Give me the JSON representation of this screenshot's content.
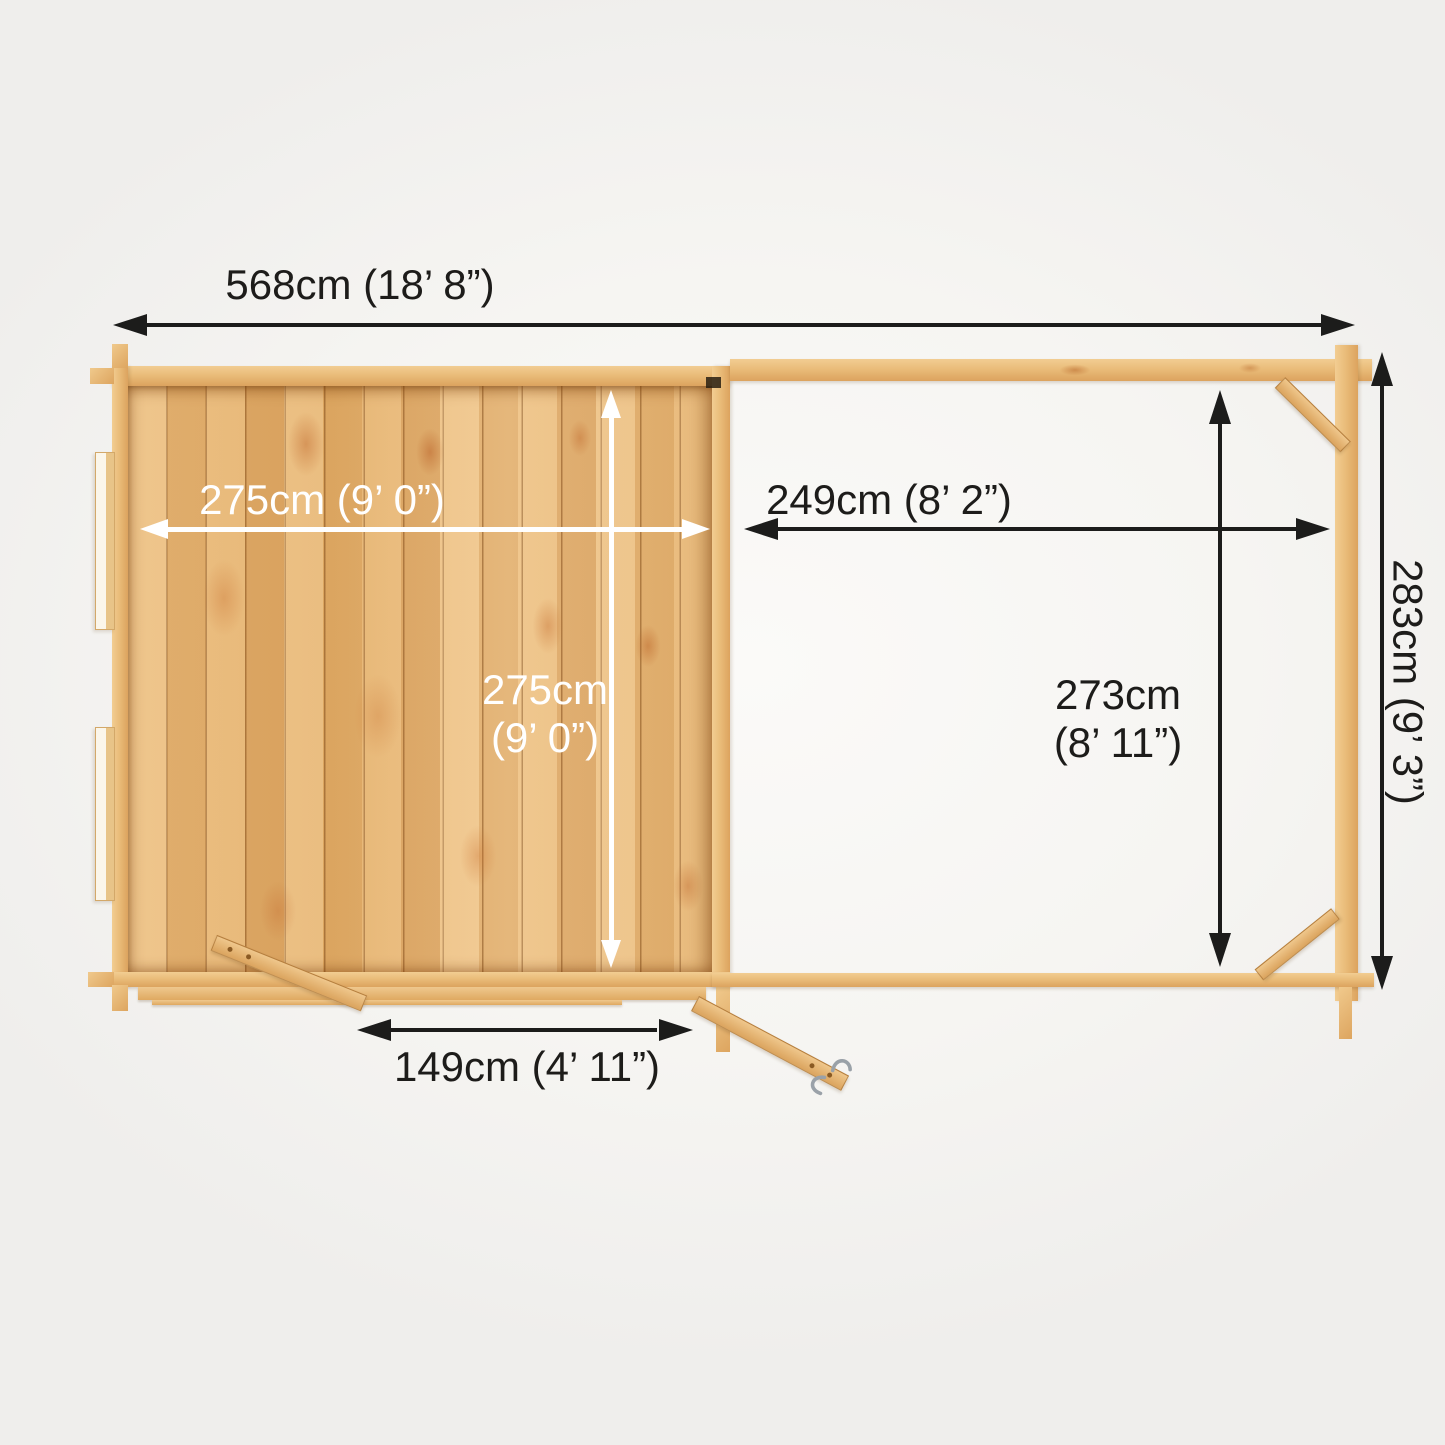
{
  "figure": {
    "kind": "top-down plan view dimension diagram",
    "subject": "log cabin with attached open canopy",
    "colors": {
      "background": "#f6f5f2",
      "wood_light": "#f2cd92",
      "wood_mid": "#e9bb78",
      "wood_dark": "#dca35e",
      "arrow_dark": "#1c1c1b",
      "arrow_light": "#ffffff",
      "text": "#1d1c1a"
    }
  },
  "dimensions": {
    "overall_width": "568cm (18’ 8”)",
    "cabin_internal_width": "275cm (9’ 0”)",
    "cabin_internal_depth_line1": "275cm",
    "cabin_internal_depth_line2": "(9’ 0”)",
    "canopy_width": "249cm (8’ 2”)",
    "canopy_depth_line1": "273cm",
    "canopy_depth_line2": "(8’ 11”)",
    "overall_depth": "283cm  (9’ 3”)",
    "door_width": "149cm  (4’ 11”)"
  }
}
